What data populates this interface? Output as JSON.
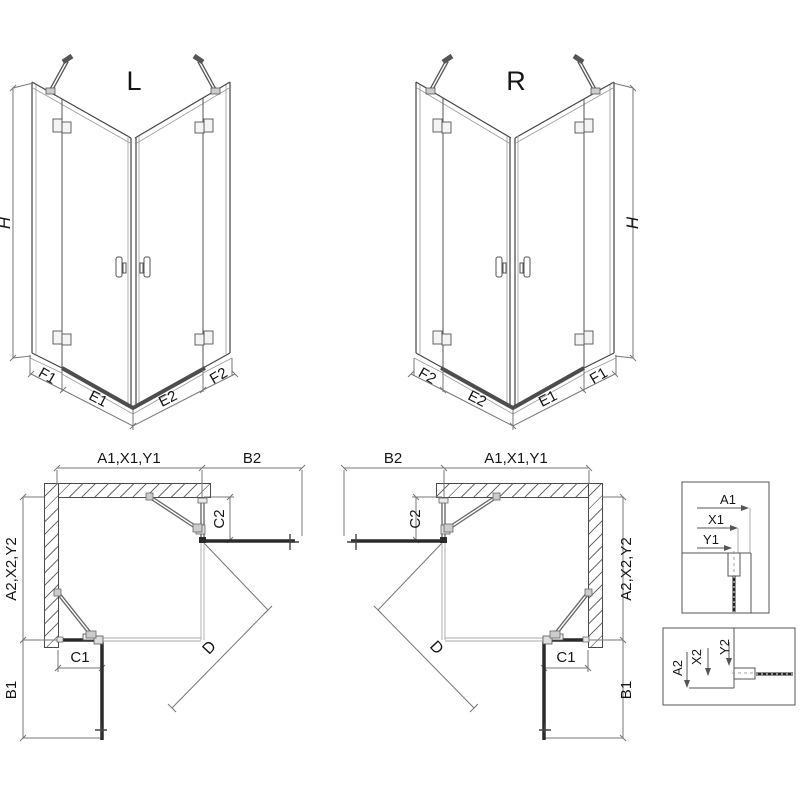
{
  "perspective_views": {
    "left": {
      "title": "L",
      "height_dim": "H",
      "base_dims": [
        "F1",
        "E1",
        "E2",
        "F2"
      ]
    },
    "right": {
      "title": "R",
      "height_dim": "H",
      "base_dims": [
        "F2",
        "E2",
        "E1",
        "F1"
      ]
    }
  },
  "plan_views": {
    "left": {
      "width_top": "A1,X1,Y1",
      "door_width_top": "B2",
      "fixed_panel_side": "C2",
      "depth_side": "A2,X2,Y2",
      "fixed_panel_bottom": "C1",
      "door_width_bottom": "B1",
      "diagonal_entry": "D"
    },
    "right": {
      "width_top": "A1,X1,Y1",
      "door_width_top": "B2",
      "fixed_panel_side": "C2",
      "depth_side": "A2,X2,Y2",
      "fixed_panel_bottom": "C1",
      "door_width_bottom": "B1",
      "diagonal_entry": "D"
    }
  },
  "detail_views": {
    "wall_profile_top": {
      "dims": [
        "A1",
        "X1",
        "Y1"
      ]
    },
    "wall_profile_bottom": {
      "dims": [
        "A2",
        "X2",
        "Y2"
      ]
    }
  },
  "colors": {
    "line_main": "#444444",
    "line_dim": "#777777",
    "door_thick": "#2b2b2b",
    "rail": "#4d4d4d"
  }
}
